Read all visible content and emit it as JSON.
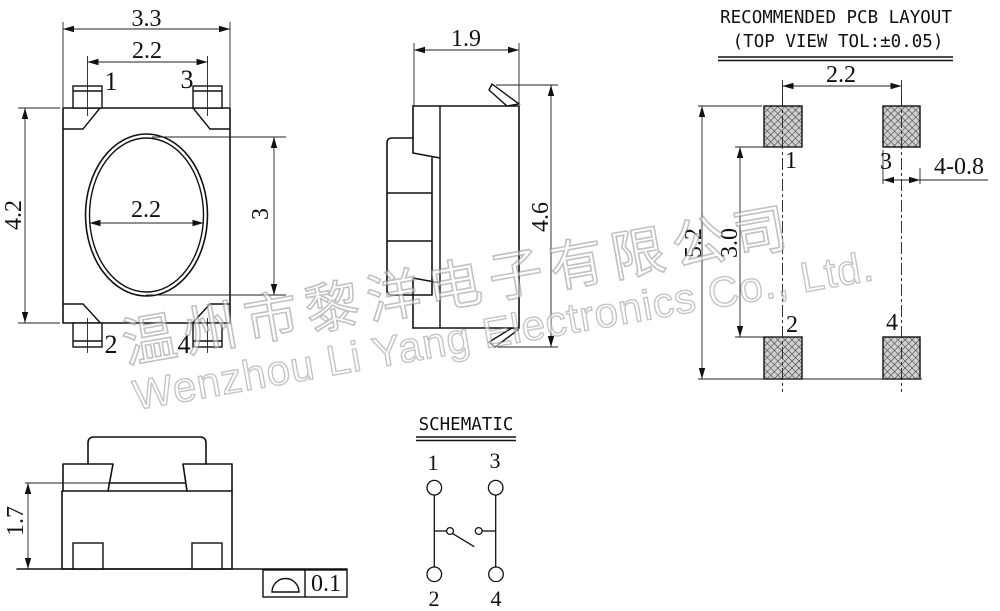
{
  "watermark": {
    "chinese": "温州市黎洋电子有限公司",
    "english": "Wenzhou Li Yang Electronics Co., Ltd."
  },
  "top_view": {
    "dim_overall_width": "3.3",
    "dim_pin_pitch": "2.2",
    "dim_overall_height": "4.2",
    "dim_button_width": "2.2",
    "dim_button_height": "3",
    "pins": {
      "p1": "1",
      "p2": "2",
      "p3": "3",
      "p4": "4"
    }
  },
  "side_view": {
    "dim_depth": "1.9",
    "dim_total_height": "4.6"
  },
  "front_view": {
    "dim_base_height": "1.7",
    "flatness_value": "0.1"
  },
  "pcb": {
    "title": "RECOMMENDED PCB LAYOUT",
    "subtitle": "(TOP VIEW TOL:±0.05)",
    "dim_pad_pitch": "2.2",
    "dim_outer_span": "5.2",
    "dim_inner_span": "3.0",
    "dim_pad_size": "4-0.8",
    "pads": {
      "p1": "1",
      "p2": "2",
      "p3": "3",
      "p4": "4"
    }
  },
  "schematic": {
    "title": "SCHEMATIC",
    "pins": {
      "p1": "1",
      "p2": "2",
      "p3": "3",
      "p4": "4"
    }
  },
  "colors": {
    "background": "#ffffff",
    "line": "#111111",
    "pad_fill": "#cfcfcf",
    "pad_hatch": "#3c3c3c",
    "watermark": "#9a9a9a"
  }
}
